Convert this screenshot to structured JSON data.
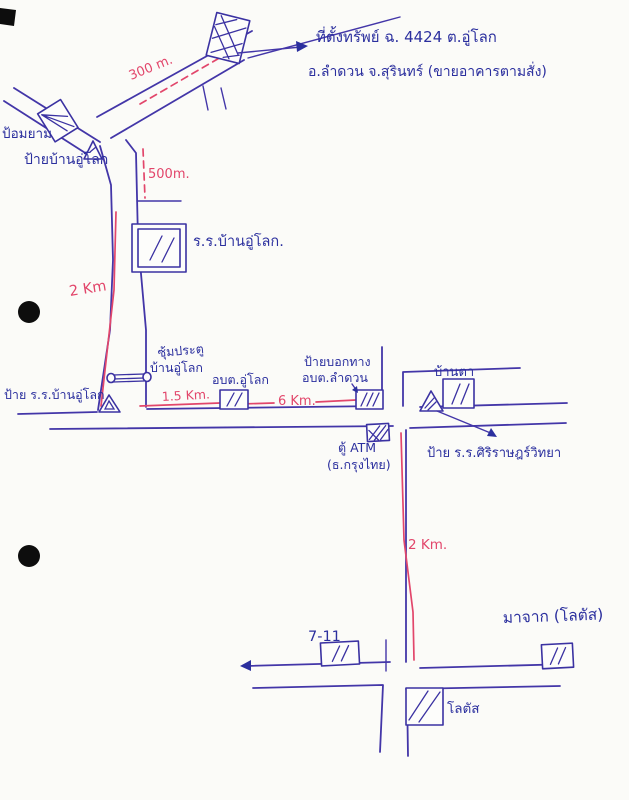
{
  "map": {
    "type": "hand-drawn-directions-map",
    "note": {
      "line1": "ที่ตั้งทรัพย์ ฉ. 4424 ต.อู่โลก",
      "line2": "อ.ลำดวน จ.สุรินทร์ (ขายอาคารตามสั่ง)"
    },
    "places": {
      "guard_post": "ป้อมยาม",
      "village_sign": "ป้ายบ้านอู่โลก",
      "school": "ร.ร.บ้านอู่โลก.",
      "gate_line1": "ซุ้มประตู",
      "gate_line2": "บ้านอู่โลก",
      "school_sign": "ป้าย ร.ร.บ้านอู่โลก",
      "sao_ulok": "อบต.อู่โลก",
      "direction_sign_line1": "ป้ายบอกทาง",
      "direction_sign_line2": "อบต.ลำดวน",
      "ban_ta": "บ้านตา",
      "siri_school_sign": "ป้าย ร.ร.ศิริราษฎร์วิทยา",
      "atm_line1": "ตู้ ATM",
      "atm_line2": "(ธ.กรุงไทย)",
      "seven_eleven": "7-11",
      "from_lotus": "มาจาก (โลตัส)",
      "lotus": "โลตัส"
    },
    "distances": {
      "to_property": "300 m.",
      "junction_leg": "500m.",
      "village_road": "2 Km",
      "gate_to_sao": "1.5 Km.",
      "sao_to_sign": "6 Km.",
      "main_to_lotus": "2 Km."
    },
    "colors": {
      "ink_blue": "#2b2f9e",
      "ink_red": "#e2466b",
      "road_blue": "#4336a8",
      "paper": "#fbfbf8"
    }
  }
}
